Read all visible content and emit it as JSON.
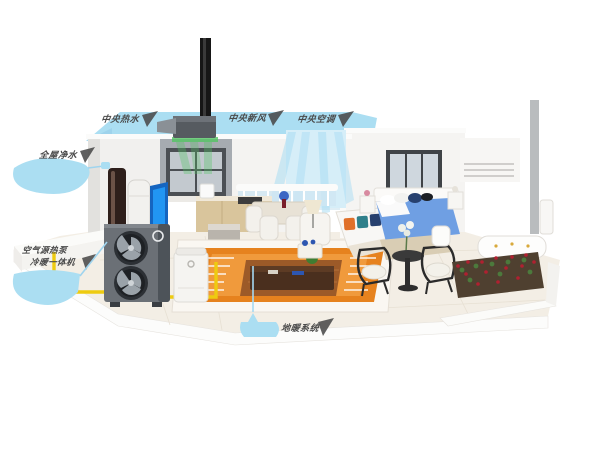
{
  "illustration": {
    "labels": {
      "banner_label_hot_water": "中央热水",
      "banner_label_fresh_air": "中央新风",
      "banner_label_air_conditioning": "中央空调",
      "water_purifier_label": "全屋净水",
      "heat_pump_label_line1": "空气源热泵",
      "heat_pump_label_line2": "冷暖一体机",
      "floor_heating_label": "地暖系统"
    },
    "colors": {
      "callout_blue": "#abdef2",
      "label_text": "#4a4a4a",
      "floor_heating_orange": "#e6821e",
      "pipe_yellow": "#eecb10",
      "heat_pump_gray": "#666d74",
      "airflow_green": "#52c463",
      "airflow_blue": "#a9dcf3",
      "bed_blue": "#6f9fe3",
      "rose_red": "#b02030"
    }
  }
}
